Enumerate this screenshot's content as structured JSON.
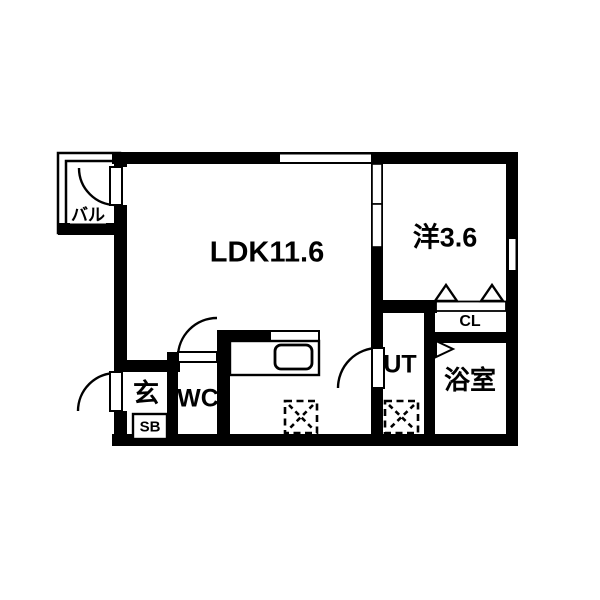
{
  "floorplan": {
    "rooms": {
      "ldk": {
        "label": "LDK11.6"
      },
      "western_room": {
        "label": "洋3.6"
      },
      "balcony": {
        "label": "バル"
      },
      "entrance": {
        "label": "玄"
      },
      "shoe_box": {
        "label": "SB"
      },
      "toilet": {
        "label": "WC"
      },
      "utility": {
        "label": "UT"
      },
      "bathroom": {
        "label": "浴室"
      },
      "closet": {
        "label": "CL"
      }
    },
    "colors": {
      "wall": "#000000",
      "background": "#ffffff"
    }
  }
}
